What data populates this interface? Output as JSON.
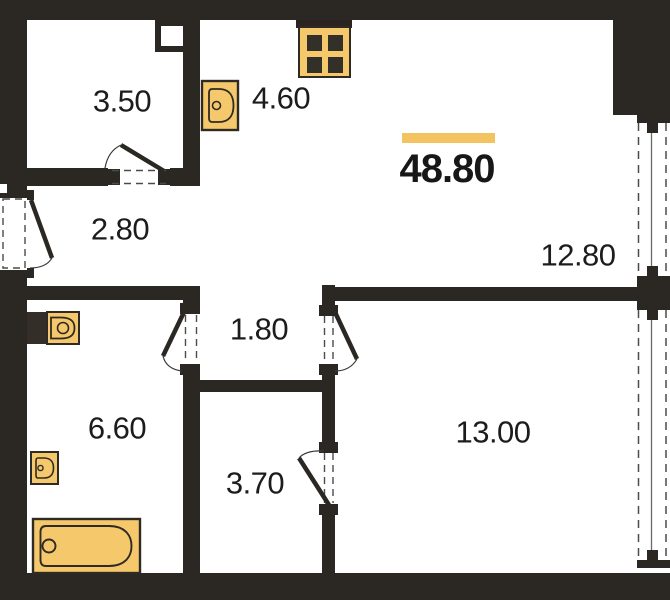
{
  "floor_plan": {
    "total_area": "48.80",
    "rooms": {
      "storage": {
        "label": "3.50"
      },
      "kitchen": {
        "label": "4.60"
      },
      "hallway": {
        "label": "2.80"
      },
      "living": {
        "label": "12.80"
      },
      "inner_hall": {
        "label": "1.80"
      },
      "bathroom": {
        "label": "6.60"
      },
      "closet": {
        "label": "3.70"
      },
      "bedroom": {
        "label": "13.00"
      }
    },
    "colors": {
      "wall": "#2b2824",
      "fixture_fill": "#f6c86c",
      "accent_bar": "#f2c35f",
      "background": "#ffffff"
    },
    "icons": [
      "stove-icon",
      "kitchen-sink-icon",
      "toilet-icon",
      "washbasin-icon",
      "bathtub-icon"
    ]
  }
}
